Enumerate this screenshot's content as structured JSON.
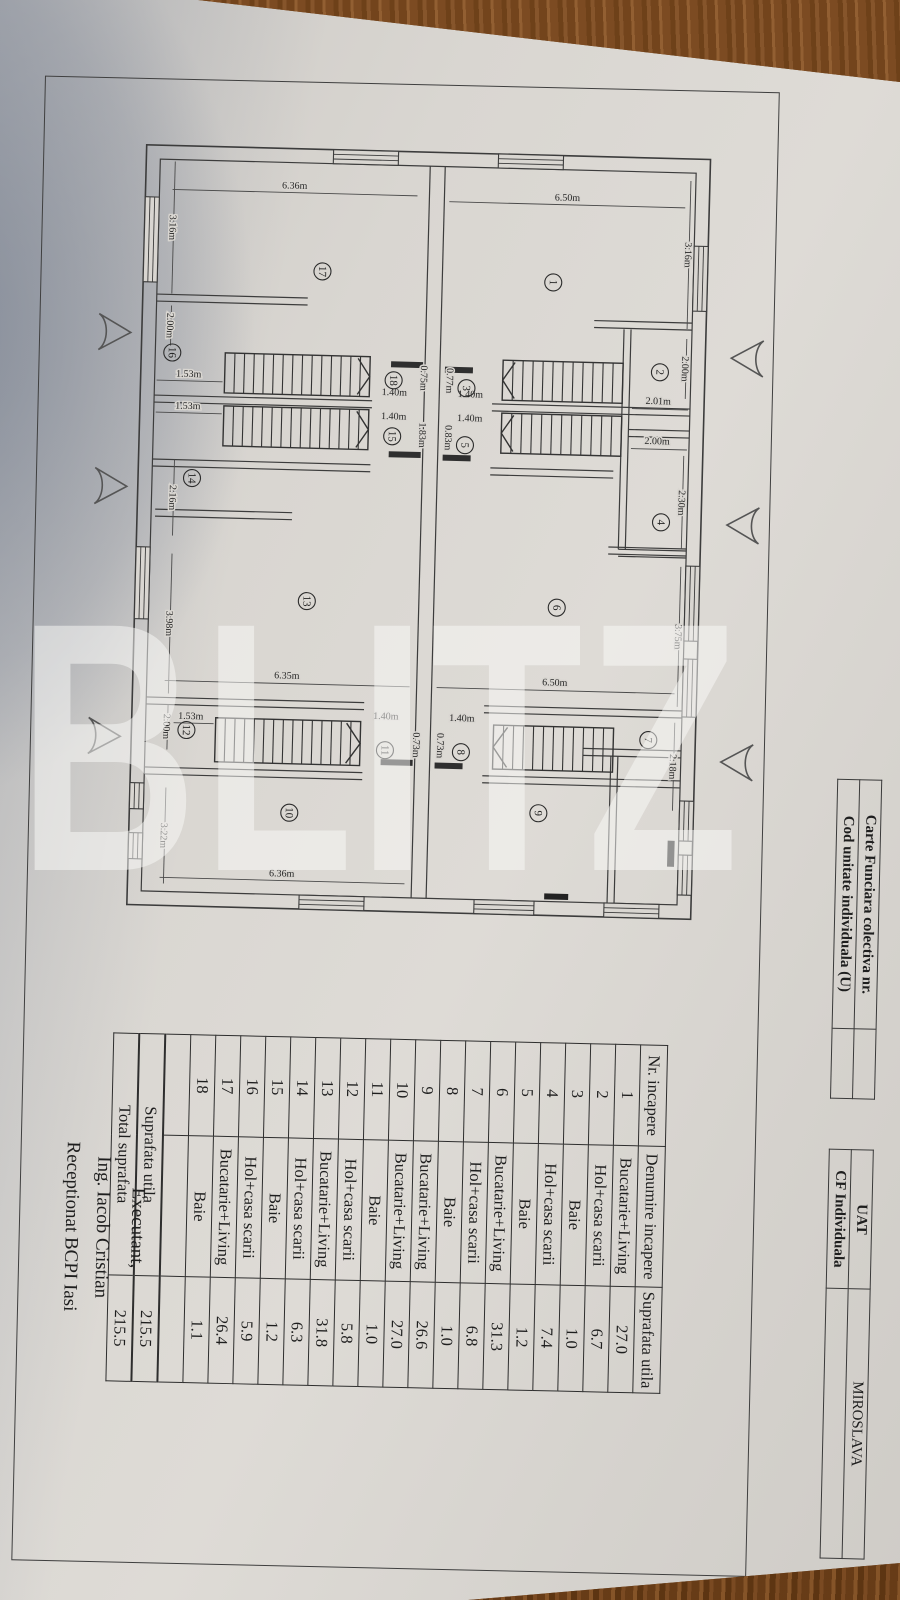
{
  "header_info": {
    "table_a": {
      "rows": [
        {
          "label": "Carte Funciara colectiva nr.",
          "value": ""
        },
        {
          "label": "Cod unitate individuala (U)",
          "value": ""
        }
      ]
    },
    "table_b": {
      "rows": [
        {
          "label": "UAT",
          "value": "MIROSLAVA"
        },
        {
          "label": "CF Individuala",
          "value": ""
        }
      ]
    }
  },
  "room_table": {
    "headers": [
      "Nr. incapere",
      "Denumire incapere",
      "Suprafata utila"
    ],
    "rows": [
      [
        "1",
        "Bucatarie+Living",
        "27.0"
      ],
      [
        "2",
        "Hol+casa scarii",
        "6.7"
      ],
      [
        "3",
        "Baie",
        "1.0"
      ],
      [
        "4",
        "Hol+casa scarii",
        "7.4"
      ],
      [
        "5",
        "Baie",
        "1.2"
      ],
      [
        "6",
        "Bucatarie+Living",
        "31.3"
      ],
      [
        "7",
        "Hol+casa scarii",
        "6.8"
      ],
      [
        "8",
        "Baie",
        "1.0"
      ],
      [
        "9",
        "Bucatarie+Living",
        "26.6"
      ],
      [
        "10",
        "Bucatarie+Living",
        "27.0"
      ],
      [
        "11",
        "Baie",
        "1.0"
      ],
      [
        "12",
        "Hol+casa scarii",
        "5.8"
      ],
      [
        "13",
        "Bucatarie+Living",
        "31.8"
      ],
      [
        "14",
        "Hol+casa scarii",
        "6.3"
      ],
      [
        "15",
        "Baie",
        "1.2"
      ],
      [
        "16",
        "Hol+casa scarii",
        "5.9"
      ],
      [
        "17",
        "Bucatarie+Living",
        "26.4"
      ],
      [
        "18",
        "Baie",
        "1.1"
      ]
    ],
    "totals": [
      [
        "Suprafata utila",
        "215.5"
      ],
      [
        "Total suprafata",
        "215.5"
      ]
    ]
  },
  "signature": {
    "line1": "Executant,",
    "line2": "Ing. Iacob Cristian",
    "line3": "Receptionat BCPI Iasi"
  },
  "watermark": "BLITZ",
  "plan": {
    "rooms": [
      {
        "n": "17",
        "x": 247,
        "y": 170
      },
      {
        "n": "1",
        "x": 478,
        "y": 175
      },
      {
        "n": "16",
        "x": 99,
        "y": 255
      },
      {
        "n": "2",
        "x": 587,
        "y": 262
      },
      {
        "n": "18",
        "x": 321,
        "y": 277
      },
      {
        "n": "3",
        "x": 394,
        "y": 283
      },
      {
        "n": "15",
        "x": 321,
        "y": 333
      },
      {
        "n": "5",
        "x": 394,
        "y": 340
      },
      {
        "n": "14",
        "x": 122,
        "y": 380
      },
      {
        "n": "4",
        "x": 592,
        "y": 412
      },
      {
        "n": "13",
        "x": 240,
        "y": 500
      },
      {
        "n": "6",
        "x": 490,
        "y": 500
      },
      {
        "n": "12",
        "x": 123,
        "y": 632
      },
      {
        "n": "7",
        "x": 585,
        "y": 630
      },
      {
        "n": "11",
        "x": 322,
        "y": 647
      },
      {
        "n": "8",
        "x": 398,
        "y": 647
      },
      {
        "n": "10",
        "x": 228,
        "y": 712
      },
      {
        "n": "9",
        "x": 477,
        "y": 706
      }
    ],
    "dims": [
      {
        "t": "6.36m",
        "x": 217,
        "y": 88,
        "r": 0
      },
      {
        "t": "6.50m",
        "x": 490,
        "y": 93,
        "r": 0
      },
      {
        "t": "3.16m",
        "x": 93,
        "y": 130,
        "r": 90
      },
      {
        "t": "3.16m",
        "x": 609,
        "y": 144,
        "r": 90
      },
      {
        "t": "2.00m",
        "x": 93,
        "y": 228,
        "r": 90
      },
      {
        "t": "2.00m",
        "x": 609,
        "y": 258,
        "r": 90
      },
      {
        "t": "1.53m",
        "x": 116,
        "y": 279,
        "r": 0
      },
      {
        "t": "1.53m",
        "x": 116,
        "y": 311,
        "r": 0
      },
      {
        "t": "1.40m",
        "x": 322,
        "y": 292,
        "r": 0
      },
      {
        "t": "1.40m",
        "x": 322,
        "y": 316,
        "r": 0
      },
      {
        "t": "1.40m",
        "x": 398,
        "y": 292,
        "r": 0
      },
      {
        "t": "1.40m",
        "x": 398,
        "y": 316,
        "r": 0
      },
      {
        "t": "0.75m",
        "x": 348,
        "y": 274,
        "r": 90
      },
      {
        "t": "1.83m",
        "x": 348,
        "y": 331,
        "r": 90
      },
      {
        "t": "0.77m",
        "x": 374,
        "y": 276,
        "r": 90
      },
      {
        "t": "0.83m",
        "x": 374,
        "y": 333,
        "r": 90
      },
      {
        "t": "2.01m",
        "x": 586,
        "y": 294,
        "r": 0
      },
      {
        "t": "2.00m",
        "x": 586,
        "y": 334,
        "r": 0
      },
      {
        "t": "2.30m",
        "x": 609,
        "y": 392,
        "r": 90
      },
      {
        "t": "2.16m",
        "x": 100,
        "y": 400,
        "r": 90
      },
      {
        "t": "3.98m",
        "x": 100,
        "y": 526,
        "r": 90
      },
      {
        "t": "3.75m",
        "x": 609,
        "y": 526,
        "r": 90
      },
      {
        "t": "6.35m",
        "x": 222,
        "y": 578,
        "r": 0
      },
      {
        "t": "6.50m",
        "x": 490,
        "y": 578,
        "r": 0
      },
      {
        "t": "1.53m",
        "x": 127,
        "y": 621,
        "r": 0
      },
      {
        "t": "1.40m",
        "x": 322,
        "y": 616,
        "r": 0
      },
      {
        "t": "1.40m",
        "x": 398,
        "y": 616,
        "r": 0
      },
      {
        "t": "0.73m",
        "x": 350,
        "y": 641,
        "r": 90
      },
      {
        "t": "0.73m",
        "x": 374,
        "y": 641,
        "r": 90
      },
      {
        "t": "2.00m",
        "x": 100,
        "y": 629,
        "r": 90
      },
      {
        "t": "2.18m",
        "x": 607,
        "y": 656,
        "r": 90
      },
      {
        "t": "3.22m",
        "x": 100,
        "y": 738,
        "r": 90
      },
      {
        "t": "6.36m",
        "x": 222,
        "y": 776,
        "r": 0
      }
    ]
  }
}
